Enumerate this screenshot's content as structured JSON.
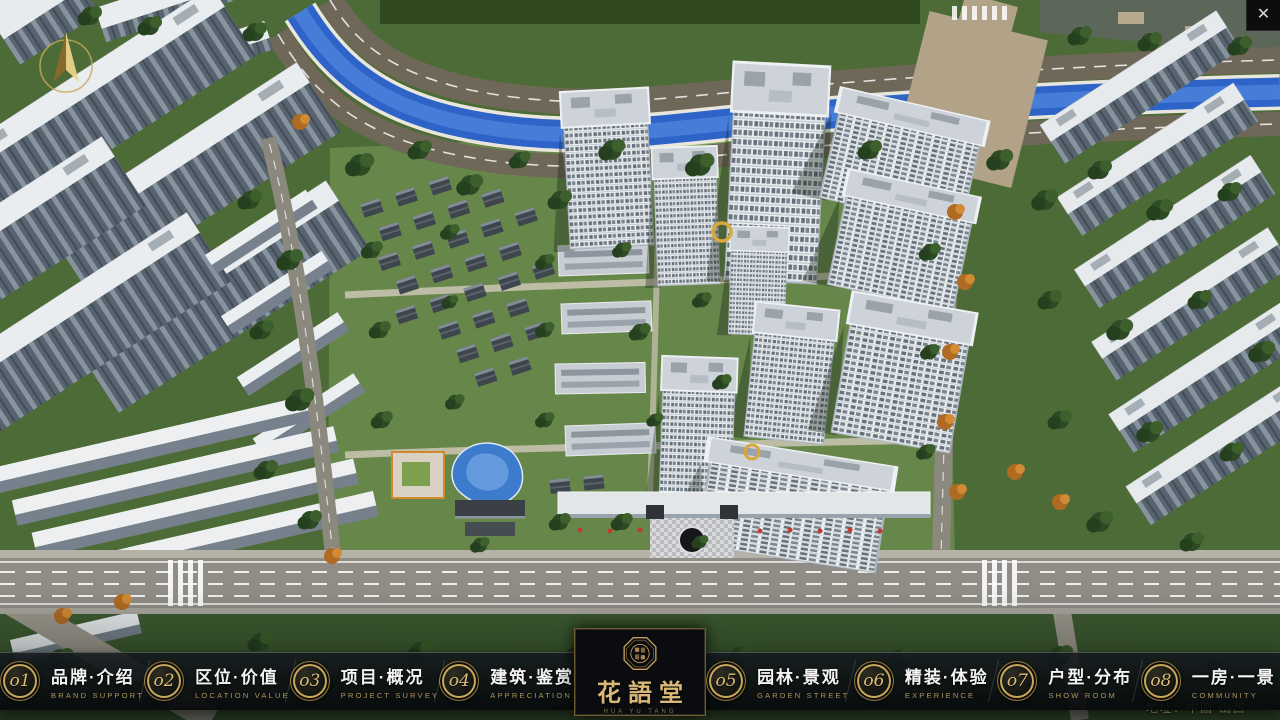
{
  "hud": {
    "close_icon": "✕",
    "address": "地址：中国·山西"
  },
  "logo": {
    "title": "花語堂",
    "tagline": "HUA YU TANG"
  },
  "nav": {
    "items": [
      {
        "num": "o1",
        "cn": "品牌·介绍",
        "en": "BRAND SUPPORT"
      },
      {
        "num": "o2",
        "cn": "区位·价值",
        "en": "LOCATION VALUE"
      },
      {
        "num": "o3",
        "cn": "项目·概况",
        "en": "PROJECT SURVEY"
      },
      {
        "num": "o4",
        "cn": "建筑·鉴赏",
        "en": "APPRECIATION"
      },
      {
        "num": "o5",
        "cn": "园林·景观",
        "en": "GARDEN STREET"
      },
      {
        "num": "o6",
        "cn": "精装·体验",
        "en": "EXPERIENCE"
      },
      {
        "num": "o7",
        "cn": "户型·分布",
        "en": "SHOW ROOM"
      },
      {
        "num": "o8",
        "cn": "一房·一景",
        "en": "COMMUNITY"
      }
    ]
  },
  "colors": {
    "gold": "#c9a85c",
    "navbar_bg": "#0b0e11",
    "river": "#2e63c8",
    "ground": "#4d6b36"
  }
}
